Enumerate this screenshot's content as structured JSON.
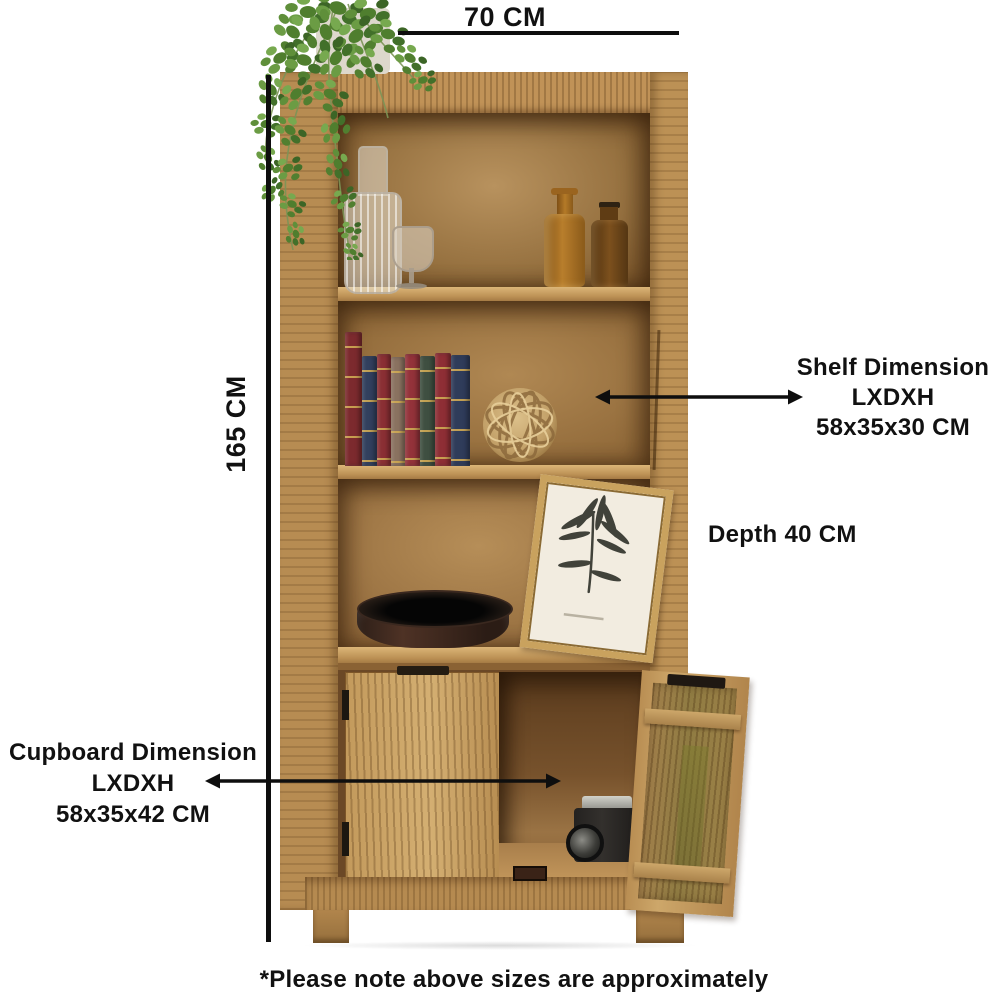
{
  "annotations": {
    "width": {
      "label": "70 CM"
    },
    "height": {
      "label": "165 CM"
    },
    "shelf": {
      "title": "Shelf Dimension",
      "format": "LXDXH",
      "size": "58x35x30 CM"
    },
    "depth": {
      "label": "Depth 40 CM"
    },
    "cupboard": {
      "title": "Cupboard Dimension",
      "format": "LXDXH",
      "size": "58x35x42 CM"
    },
    "footnote": "*Please note above sizes are approximately"
  },
  "icons": {
    "width_line": "horizontal-dimension-line",
    "height_line": "vertical-dimension-line",
    "shelf_arrow": "double-headed-arrow",
    "cupboard_arrow": "double-headed-arrow"
  },
  "colors": {
    "annotation": "#111111",
    "background": "#ffffff",
    "wood_light": "#cda76a",
    "wood_mid": "#ad7f47",
    "wood_dark": "#6b4826"
  }
}
